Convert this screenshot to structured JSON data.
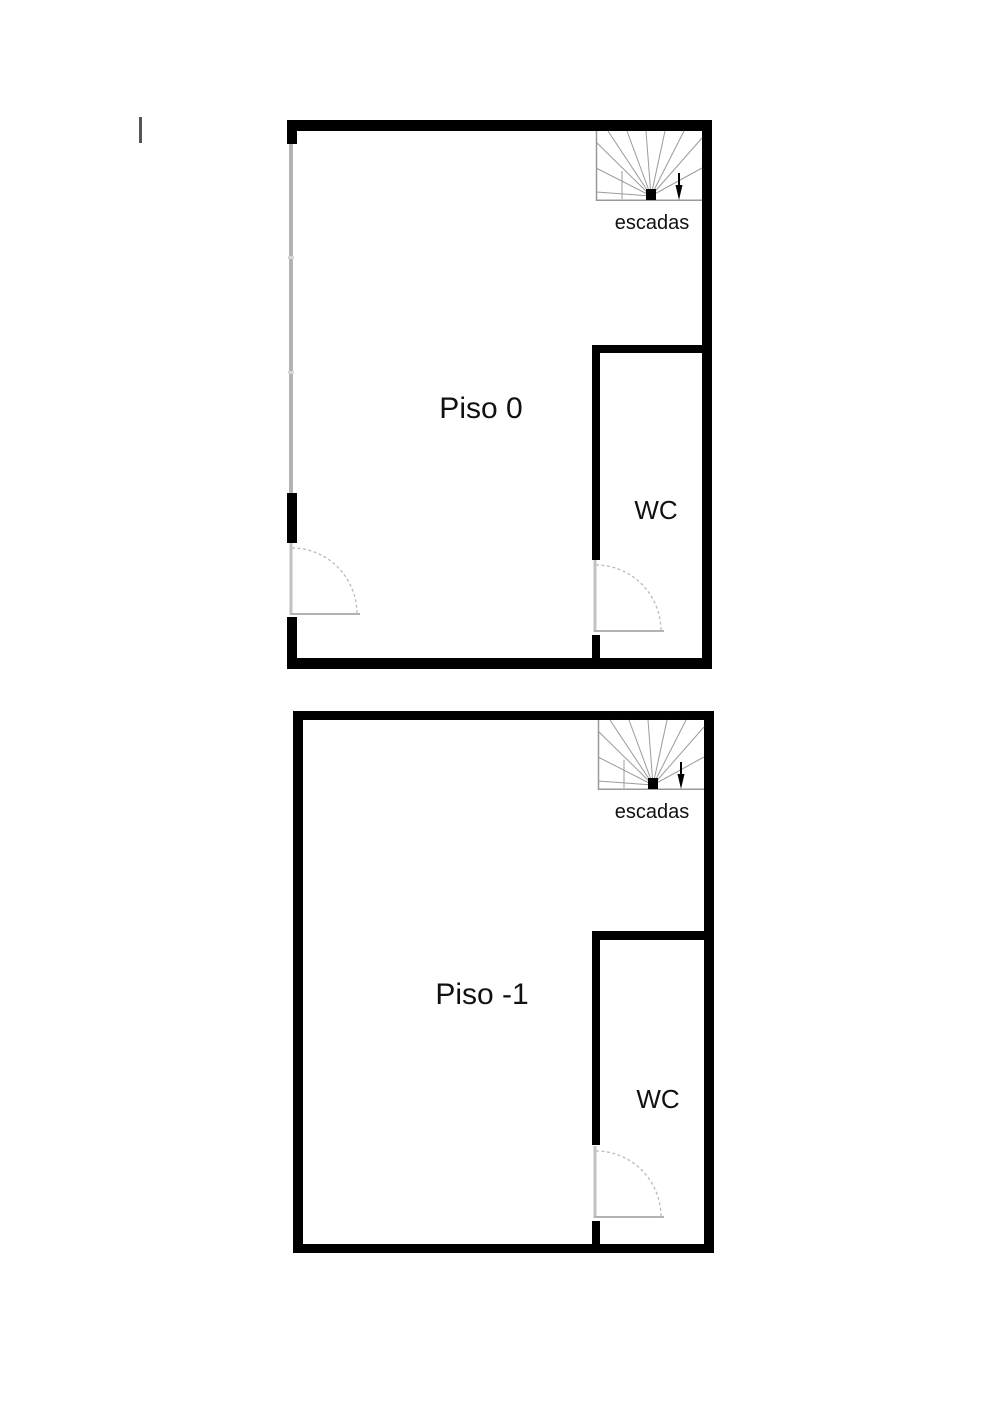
{
  "drawing": {
    "title": "floor-plans",
    "plans": [
      {
        "name": "Piso 0",
        "wc": "WC",
        "stairs": "escadas"
      },
      {
        "name": "Piso -1",
        "wc": "WC",
        "stairs": "escadas"
      }
    ]
  },
  "colors": {
    "wall": "#000000",
    "window_line": "#b3b3b3",
    "door_line": "#b9b9b9",
    "stair_line": "#999999",
    "text": "#111111",
    "background": "#ffffff"
  }
}
